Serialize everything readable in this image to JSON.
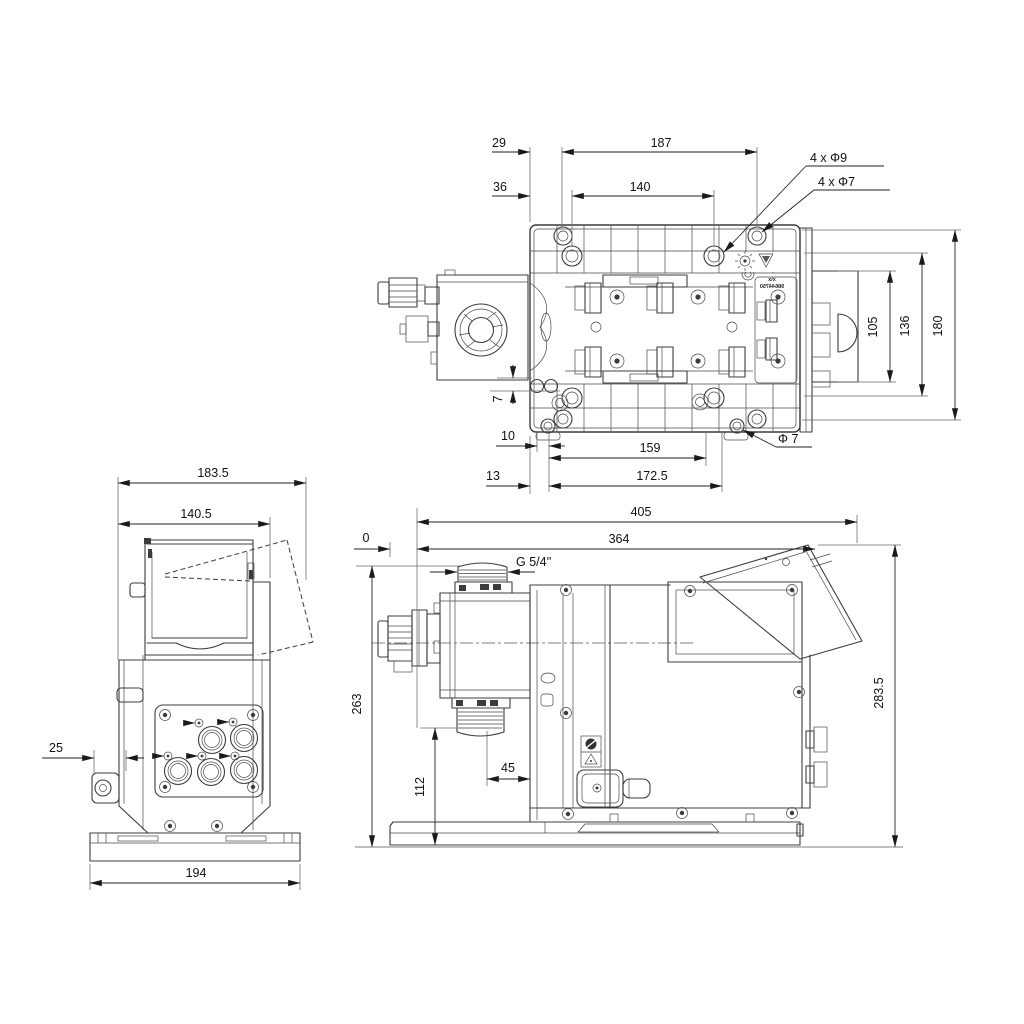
{
  "colors": {
    "line": "#3c3c3c",
    "dimension_text": "#111111",
    "background": "#ffffff"
  },
  "top_view": {
    "d29": "29",
    "d187": "187",
    "d36": "36",
    "d140": "140",
    "holes_outer": "4 x Φ9",
    "holes_inner": "4 x Φ7",
    "d105": "105",
    "d136": "136",
    "d180": "180",
    "d7": "7",
    "d10": "10",
    "d159": "159",
    "dphi7": "Φ 7",
    "d13": "13",
    "d172_5": "172.5",
    "marking_top": "x/x",
    "marking_serial": "98644750"
  },
  "front_view": {
    "d183_5": "183.5",
    "d140_5": "140.5",
    "d25": "25",
    "d194": "194"
  },
  "side_view": {
    "d405": "405",
    "d364": "364",
    "d0": "0",
    "thread": "G 5/4''",
    "d263": "263",
    "d283_5": "283.5",
    "d112": "112",
    "d45": "45"
  }
}
